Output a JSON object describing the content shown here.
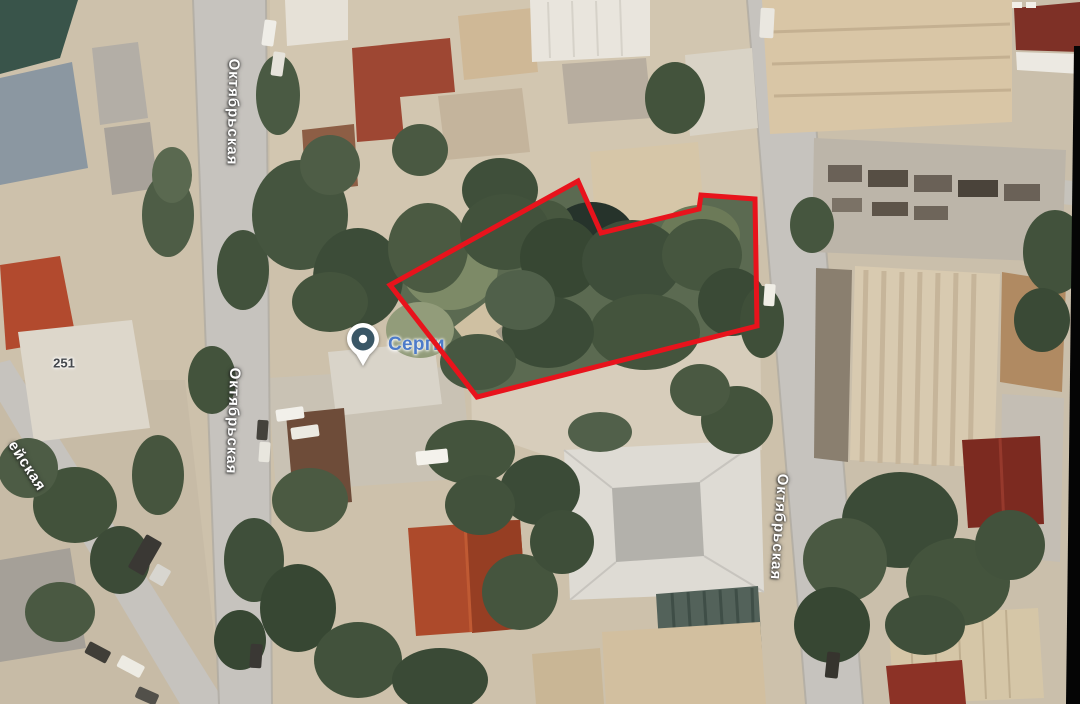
{
  "map": {
    "view_type": "satellite",
    "road_labels": {
      "left_road_top": "Октябрьская",
      "left_road_bottom": "Октябрьская",
      "right_road": "Октябрьская",
      "edge_road_partial": "ейская"
    },
    "house_number": "251",
    "poi": {
      "label": "Серги",
      "icon": "map-pin"
    },
    "overlay": {
      "plot_outline_color": "#e8131c"
    },
    "colors": {
      "poi_label": "#4d7bc9",
      "road": "#c6c3be",
      "ground": "#cdc1ab",
      "vegetation": "#45553f"
    }
  }
}
